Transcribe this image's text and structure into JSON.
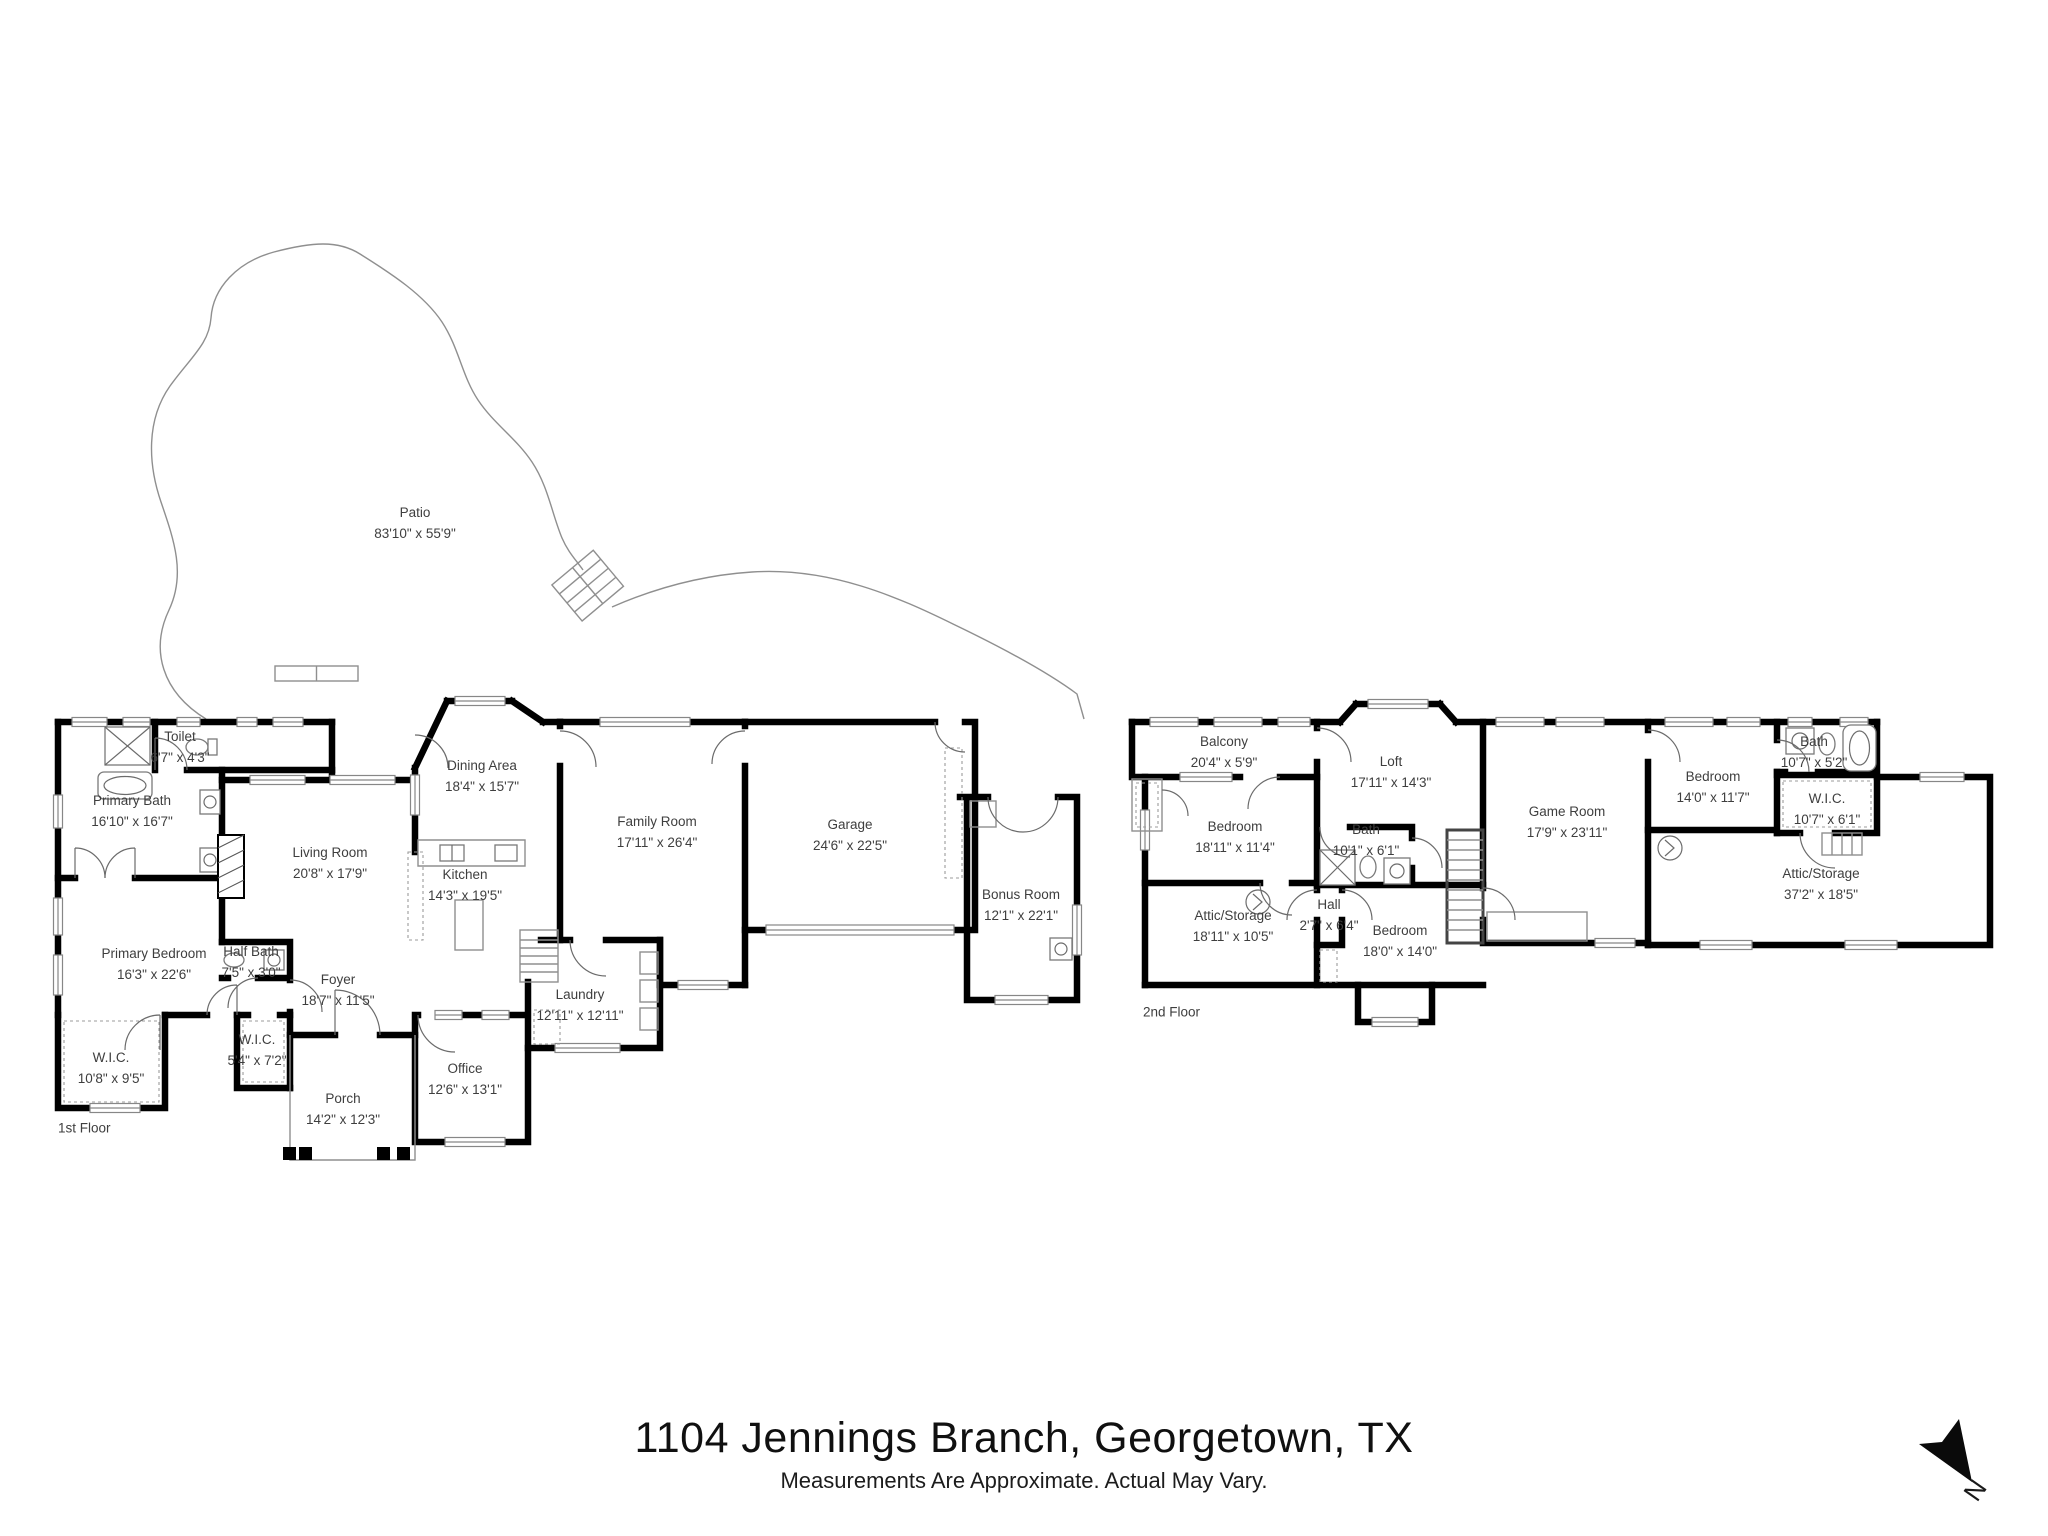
{
  "page": {
    "title": "1104 Jennings Branch, Georgetown, TX",
    "disclaimer": "Measurements Are Approximate. Actual May Vary."
  },
  "compass": {
    "label": "N"
  },
  "colors": {
    "wall": "#000000",
    "label_text": "#3e3e3e",
    "thin_line": "#9b9b9b",
    "background": "#ffffff"
  },
  "floors": {
    "first": {
      "tag": {
        "label": "1st Floor",
        "x": 58,
        "y": 1128
      },
      "rooms": [
        {
          "name": "Patio",
          "dims": "83'10\" x 55'9\"",
          "x": 415,
          "y": 524
        },
        {
          "name": "Toilet",
          "dims": "6'7\" x 4'3\"",
          "x": 180,
          "y": 748
        },
        {
          "name": "Primary Bath",
          "dims": "16'10\" x 16'7\"",
          "x": 132,
          "y": 812
        },
        {
          "name": "Dining Area",
          "dims": "18'4\" x 15'7\"",
          "x": 482,
          "y": 777
        },
        {
          "name": "Family Room",
          "dims": "17'11\" x 26'4\"",
          "x": 657,
          "y": 833
        },
        {
          "name": "Garage",
          "dims": "24'6\" x 22'5\"",
          "x": 850,
          "y": 836
        },
        {
          "name": "Living Room",
          "dims": "20'8\" x 17'9\"",
          "x": 330,
          "y": 864
        },
        {
          "name": "Kitchen",
          "dims": "14'3\" x 19'5\"",
          "x": 465,
          "y": 886
        },
        {
          "name": "Bonus Room",
          "dims": "12'1\" x 22'1\"",
          "x": 1021,
          "y": 906
        },
        {
          "name": "Primary Bedroom",
          "dims": "16'3\" x 22'6\"",
          "x": 154,
          "y": 965
        },
        {
          "name": "Half Bath",
          "dims": "7'5\" x 3'0\"",
          "x": 251,
          "y": 963
        },
        {
          "name": "Foyer",
          "dims": "18'7\" x 11'5\"",
          "x": 338,
          "y": 991
        },
        {
          "name": "Laundry",
          "dims": "12'11\" x 12'11\"",
          "x": 580,
          "y": 1006
        },
        {
          "name": "W.I.C.",
          "dims": "5'4\" x 7'2\"",
          "x": 257,
          "y": 1051
        },
        {
          "name": "W.I.C.",
          "dims": "10'8\" x 9'5\"",
          "x": 111,
          "y": 1069
        },
        {
          "name": "Office",
          "dims": "12'6\" x 13'1\"",
          "x": 465,
          "y": 1080
        },
        {
          "name": "Porch",
          "dims": "14'2\" x 12'3\"",
          "x": 343,
          "y": 1110
        }
      ]
    },
    "second": {
      "tag": {
        "label": "2nd Floor",
        "x": 1143,
        "y": 1012
      },
      "rooms": [
        {
          "name": "Balcony",
          "dims": "20'4\" x 5'9\"",
          "x": 1224,
          "y": 753
        },
        {
          "name": "Bath",
          "dims": "10'7\" x 5'2\"",
          "x": 1814,
          "y": 753
        },
        {
          "name": "Loft",
          "dims": "17'11\" x 14'3\"",
          "x": 1391,
          "y": 773
        },
        {
          "name": "Bedroom",
          "dims": "14'0\" x 11'7\"",
          "x": 1713,
          "y": 788
        },
        {
          "name": "W.I.C.",
          "dims": "10'7\" x 6'1\"",
          "x": 1827,
          "y": 810
        },
        {
          "name": "Game Room",
          "dims": "17'9\" x 23'11\"",
          "x": 1567,
          "y": 823
        },
        {
          "name": "Bedroom",
          "dims": "18'11\" x 11'4\"",
          "x": 1235,
          "y": 838
        },
        {
          "name": "Bath",
          "dims": "10'1\" x 6'1\"",
          "x": 1366,
          "y": 841
        },
        {
          "name": "Attic/Storage",
          "dims": "37'2\" x 18'5\"",
          "x": 1821,
          "y": 885
        },
        {
          "name": "Hall",
          "dims": "2'7\" x 6'4\"",
          "x": 1329,
          "y": 916
        },
        {
          "name": "Attic/Storage",
          "dims": "18'11\" x 10'5\"",
          "x": 1233,
          "y": 927
        },
        {
          "name": "Bedroom",
          "dims": "18'0\" x 14'0\"",
          "x": 1400,
          "y": 942
        }
      ]
    }
  }
}
